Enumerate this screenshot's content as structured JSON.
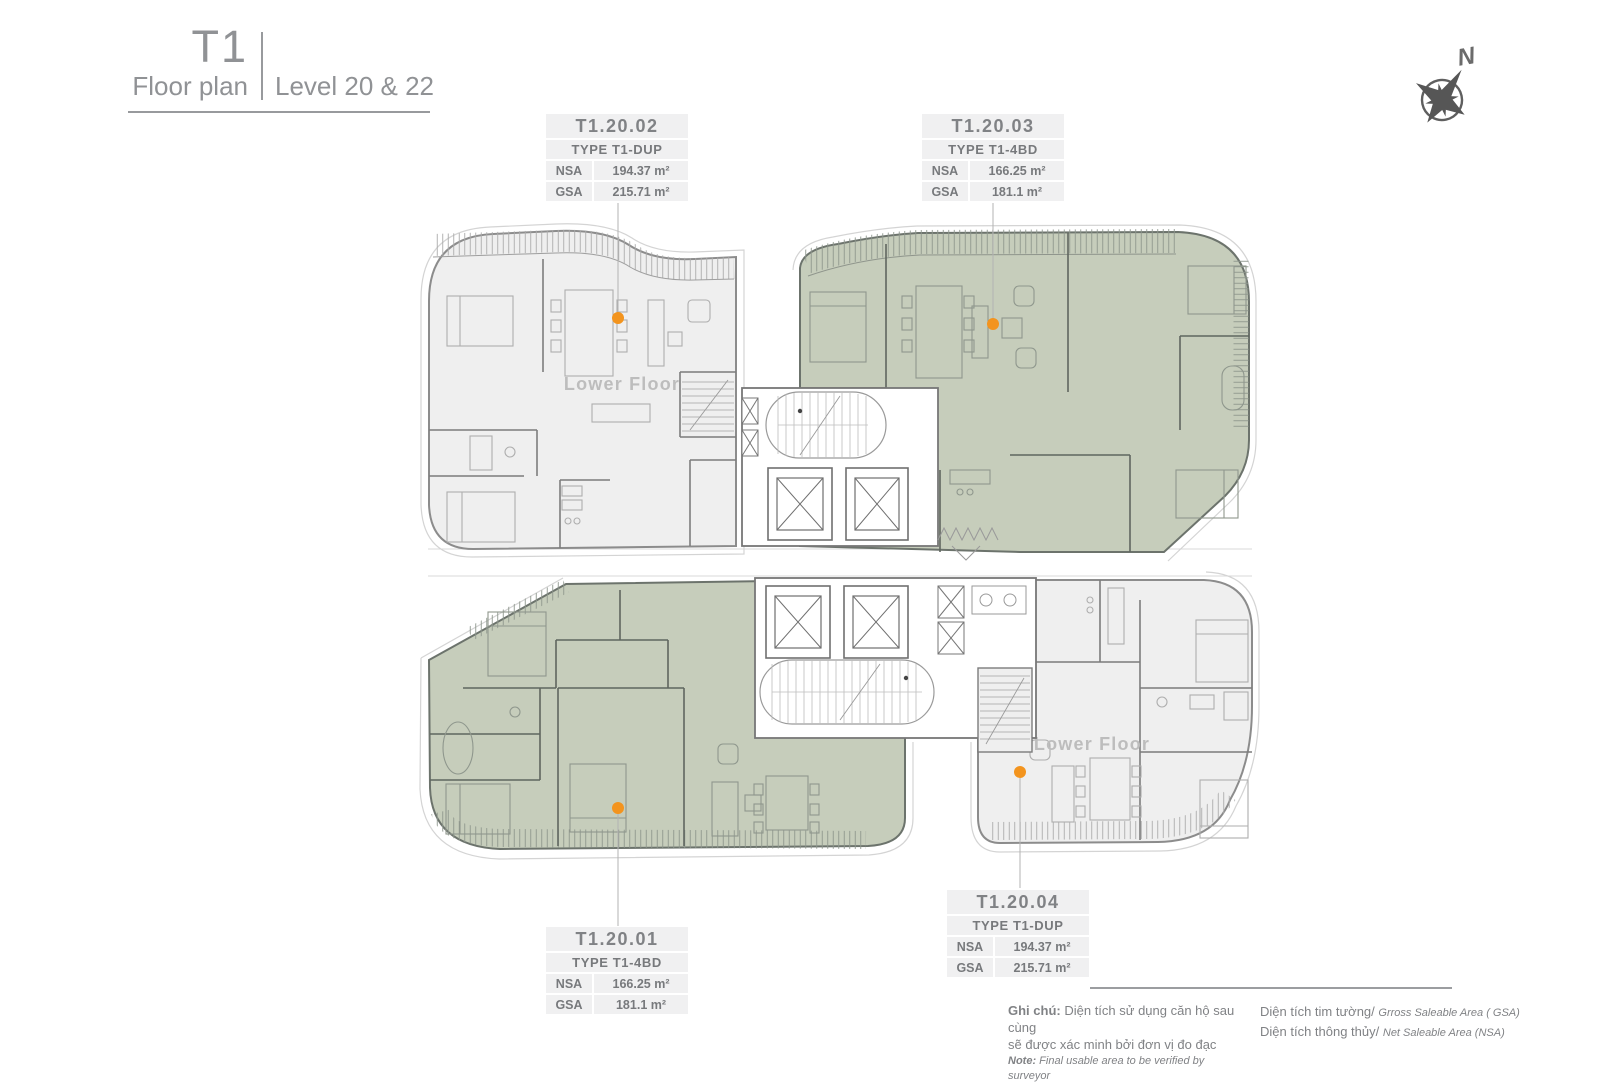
{
  "header": {
    "tower": "T1",
    "subtitle": "Floor plan",
    "level": "Level 20 & 22"
  },
  "compass": {
    "north_label": "N"
  },
  "area_labels": {
    "nsa": "NSA",
    "gsa": "GSA"
  },
  "units": [
    {
      "id": "T1.20.02",
      "type": "TYPE T1-DUP",
      "nsa": "194.37 m²",
      "gsa": "215.71 m²",
      "floor_note": "Lower Floor",
      "highlighted": false
    },
    {
      "id": "T1.20.03",
      "type": "TYPE T1-4BD",
      "nsa": "166.25 m²",
      "gsa": "181.1 m²",
      "floor_note": "",
      "highlighted": true
    },
    {
      "id": "T1.20.01",
      "type": "TYPE T1-4BD",
      "nsa": "166.25 m²",
      "gsa": "181.1 m²",
      "floor_note": "",
      "highlighted": true
    },
    {
      "id": "T1.20.04",
      "type": "TYPE T1-DUP",
      "nsa": "194.37 m²",
      "gsa": "215.71 m²",
      "floor_note": "Lower Floor",
      "highlighted": false
    }
  ],
  "notes": {
    "left_label": "Ghi chú:",
    "left_line1": "Diện tích sử dụng căn hộ sau cùng",
    "left_line2": "sẽ được xác minh bởi đơn vị đo đạc",
    "note_label": "Note:",
    "note_text": "Final usable area to be verified by surveyor",
    "right": [
      {
        "vn": "Diện tích tim tường/",
        "en": "Grross Saleable Area ( GSA)"
      },
      {
        "vn": "Diện tích thông thủy/",
        "en": "Net Saleable Area (NSA)"
      }
    ]
  },
  "colors": {
    "highlight_green": "#c6cdbb",
    "unit_fill": "#efefef",
    "marker_orange": "#f3941e",
    "label_bg": "#f0f0f1",
    "text_gray": "#808285"
  }
}
